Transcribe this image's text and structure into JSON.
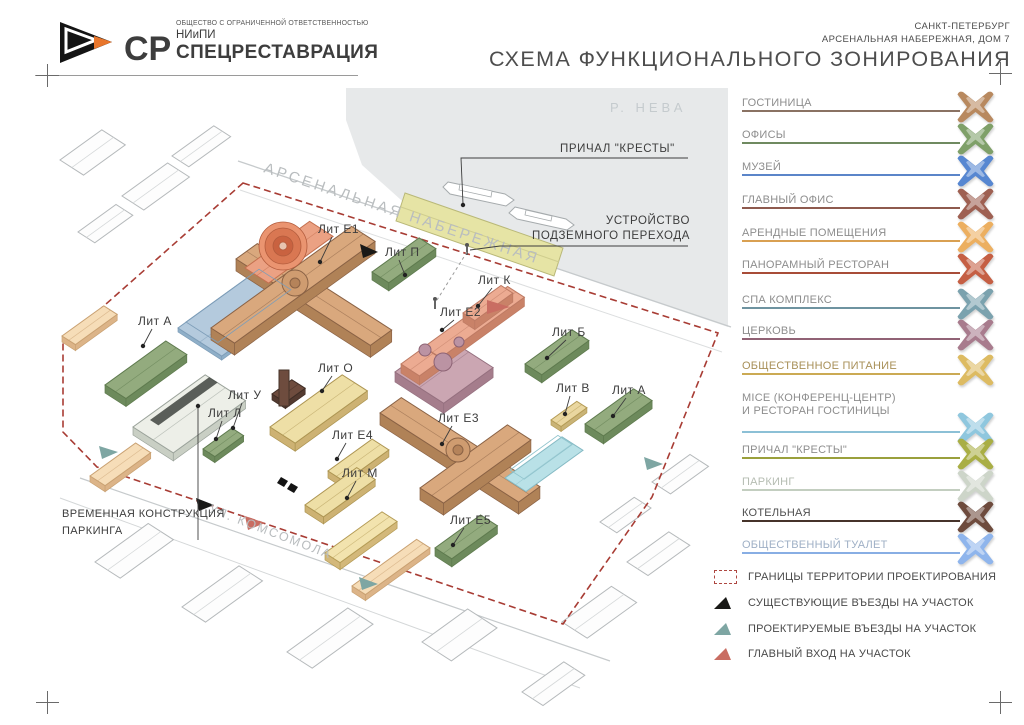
{
  "header": {
    "company_type": "ОБЩЕСТВО С ОГРАНИЧЕННОЙ ОТВЕТСТВЕННОСТЬЮ",
    "org_short": "НИиПИ",
    "org_name": "СПЕЦРЕСТАВРАЦИЯ",
    "monogram": "СР",
    "city": "САНКТ-ПЕТЕРБУРГ",
    "address": "АРСЕНАЛЬНАЯ НАБЕРЕЖНАЯ, ДОМ 7",
    "title": "СХЕМА ФУНКЦИОНАЛЬНОГО ЗОНИРОВАНИЯ"
  },
  "map": {
    "river": "Р. НЕВА",
    "embankment": "АРСЕНАЛЬНАЯ НАБЕРЕЖНАЯ",
    "street": "УЛ. КОМСОМОЛА",
    "pier": "ПРИЧАЛ \"КРЕСТЫ\"",
    "underpass1": "УСТРОЙСТВО",
    "underpass2": "ПОДЗЕМНОГО ПЕРЕХОДА",
    "parking1": "ВРЕМЕННАЯ КОНСТРУКЦИЯ",
    "parking2": "ПАРКИНГА",
    "labels": [
      "Лит Е1",
      "Лит П",
      "Лит К",
      "Лит Е2",
      "Лит Б",
      "Лит В",
      "Лит А",
      "Лит О",
      "Лит Е3",
      "Лит Е4",
      "Лит М",
      "Лит Е5",
      "Лит У",
      "Лит Л",
      "Лит А"
    ]
  },
  "legend": {
    "zones": [
      {
        "label": "ГОСТИНИЦА",
        "color": "#b8895f",
        "line": "#8a7263",
        "text": "#8d8d8d"
      },
      {
        "label": "ОФИСЫ",
        "color": "#7fa069",
        "line": "#6f8a60",
        "text": "#8d8d8d"
      },
      {
        "label": "МУЗЕЙ",
        "color": "#5787d1",
        "line": "#5b85c9",
        "text": "#8d8d8d"
      },
      {
        "label": "ГЛАВНЫЙ ОФИС",
        "color": "#9e6052",
        "line": "#8e5a4e",
        "text": "#8d8d8d"
      },
      {
        "label": "АРЕНДНЫЕ ПОМЕЩЕНИЯ",
        "color": "#ecaf60",
        "line": "#d9a052",
        "text": "#8d8d8d"
      },
      {
        "label": "ПАНОРАМНЫЙ РЕСТОРАН",
        "color": "#c55f44",
        "line": "#a84c38",
        "text": "#8d8d8d"
      },
      {
        "label": "СПА КОМПЛЕКС",
        "color": "#7ba2ae",
        "line": "#6e93a0",
        "text": "#8d8d8d"
      },
      {
        "label": "ЦЕРКОВЬ",
        "color": "#a87b8d",
        "line": "#916275",
        "text": "#8d8d8d"
      },
      {
        "label": "ОБЩЕСТВЕННОЕ ПИТАНИЕ",
        "color": "#ddbb62",
        "line": "#cbaa54",
        "text": "#a89058"
      },
      {
        "label": "MICE (КОНФЕРЕНЦ-ЦЕНТР)",
        "label2": "И РЕСТОРАН ГОСТИНИЦЫ",
        "color": "#8fc7de",
        "line": "#8cc0d6",
        "text": "#8d8d8d"
      },
      {
        "label": "ПРИЧАЛ \"КРЕСТЫ\"",
        "color": "#a9ae45",
        "line": "#9aa03c",
        "text": "#8d8d8d"
      },
      {
        "label": "ПАРКИНГ",
        "color": "#cdd5c9",
        "line": "#c3cec0",
        "text": "#b5bcb2"
      },
      {
        "label": "КОТЕЛЬНАЯ",
        "color": "#6e4b3d",
        "line": "#46332a",
        "text": "#4f4f4f"
      },
      {
        "label": "ОБЩЕСТВЕННЫЙ ТУАЛЕТ",
        "color": "#8fb5ec",
        "line": "#88aee4",
        "text": "#9fb0c6"
      }
    ],
    "symbols": [
      {
        "label": "ГРАНИЦЫ ТЕРРИТОРИИ ПРОЕКТИРОВАНИЯ",
        "color": "#ae4741",
        "type": "boundary"
      },
      {
        "label": "СУЩЕСТВУЮЩИЕ ВЪЕЗДЫ НА УЧАСТОК",
        "color": "#191917",
        "type": "triangle"
      },
      {
        "label": "ПРОЕКТИРУЕМЫЕ ВЪЕЗДЫ НА УЧАСТОК",
        "color": "#7ea6a3",
        "type": "triangle"
      },
      {
        "label": "ГЛАВНЫЙ ВХОД НА УЧАСТОК",
        "color": "#c96d62",
        "type": "triangle"
      }
    ]
  }
}
